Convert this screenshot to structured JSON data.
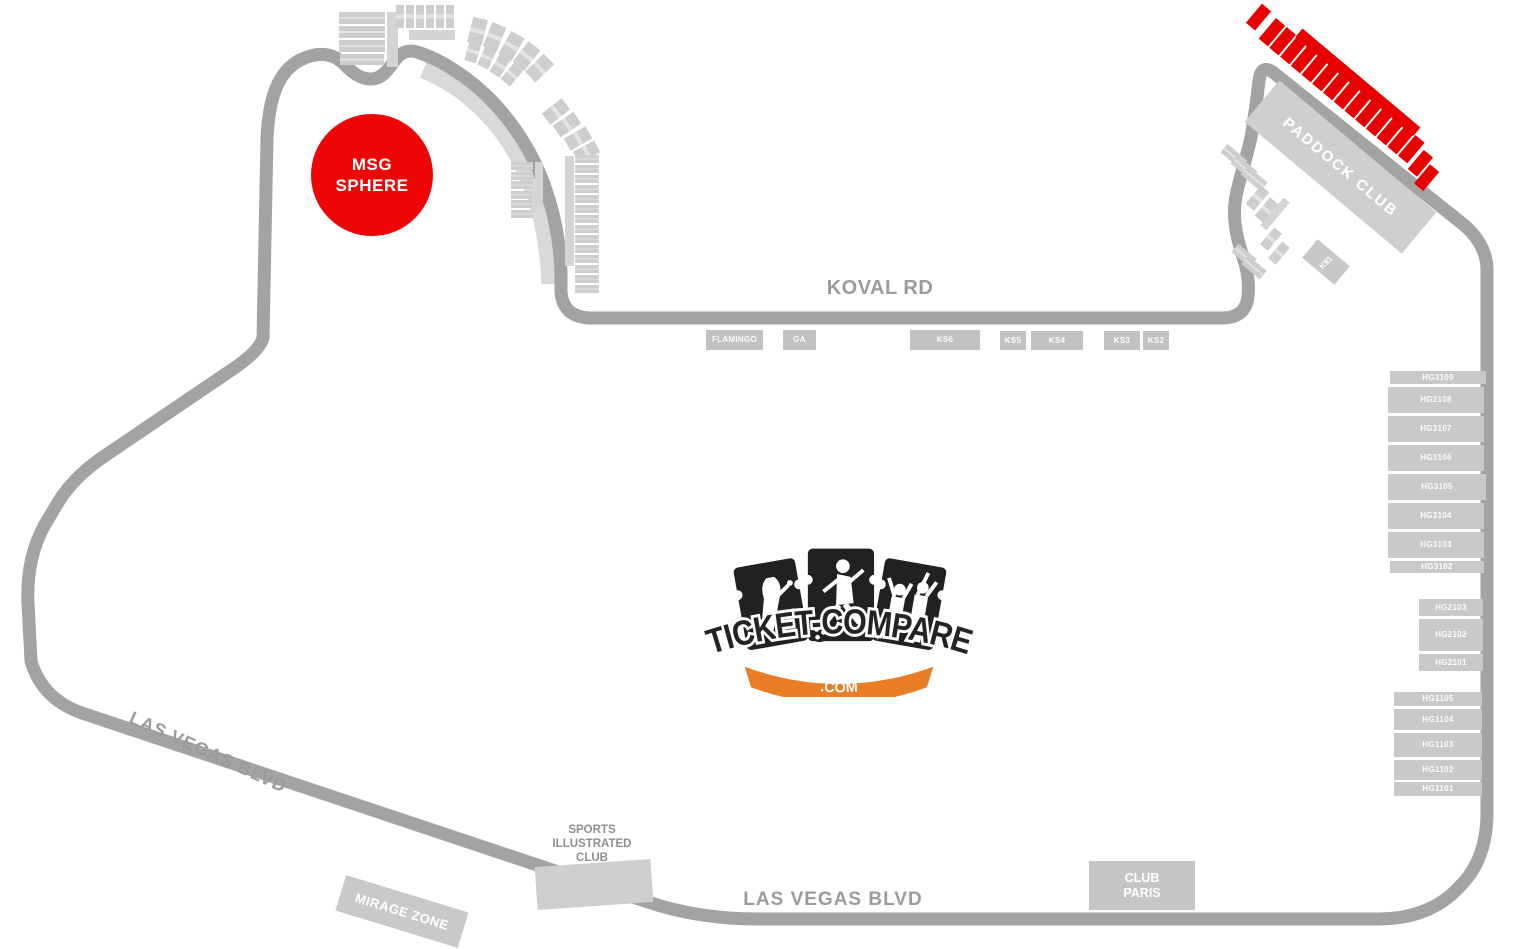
{
  "logo": {
    "title": "TICKET-COMPARE",
    "tld": ".COM"
  },
  "roads": {
    "koval_rd": "KOVAL RD",
    "las_vegas_blvd_west": "LAS VEGAS BLVD",
    "las_vegas_blvd_south": "LAS VEGAS BLVD"
  },
  "landmarks": {
    "msg_sphere": {
      "line1": "MSG",
      "line2": "SPHERE"
    },
    "paddock_club": "PADDOCK CLUB",
    "k91": "K91",
    "mirage_zone": "MIRAGE ZONE",
    "club_paris": {
      "line1": "CLUB",
      "line2": "PARIS"
    },
    "sports_illustrated_club": {
      "line1": "SPORTS",
      "line2": "ILLUSTRATED",
      "line3": "CLUB"
    }
  },
  "sections": {
    "koval_row": [
      "FLAMINGO",
      "GA",
      "KS6",
      "KS5",
      "KS4",
      "KS3",
      "KS2"
    ],
    "hg3": [
      "HG3109",
      "HG3108",
      "HG3107",
      "HG3106",
      "HG3105",
      "HG3104",
      "HG3103",
      "HG3102"
    ],
    "hg2": [
      "HG2103",
      "HG2102",
      "HG2101"
    ],
    "hg1": [
      "HG1105",
      "HG1104",
      "HG1103",
      "HG1102",
      "HG1101"
    ]
  },
  "colors": {
    "track_gray": "#a3a3a3",
    "zone_light": "#d9d9d9",
    "section_gray": "#c6c6c6",
    "highlight_red": "#e80000",
    "sphere_red": "#ee0505",
    "logo_orange": "#e87d26"
  }
}
